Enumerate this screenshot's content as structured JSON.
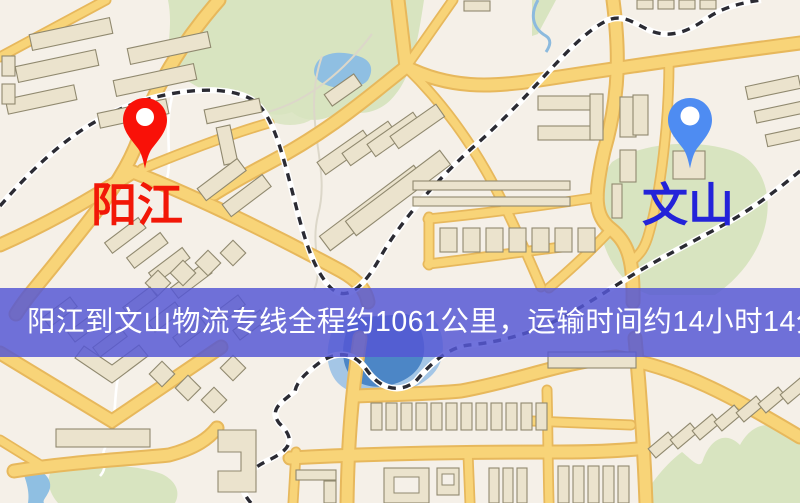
{
  "banner": {
    "text": "阳江到文山物流专线全程约1061公里，运输时间约14小时14分钟.",
    "background_color": "#5557d4",
    "text_color": "#ffffff"
  },
  "markers": [
    {
      "name": "origin",
      "label": "阳江",
      "pin_color": "#f91108",
      "label_color": "#f21707"
    },
    {
      "name": "destination",
      "label": "文山",
      "pin_color": "#4e8cf2",
      "label_color": "#2323d9"
    }
  ],
  "route": {
    "origin": "阳江",
    "destination": "文山",
    "distance": "约1061公里",
    "duration": "约14小时14分钟"
  },
  "map_palette": {
    "map_bg": "#f5f0e8",
    "green": "#d8e4c0",
    "water_light": "#a4c6e6",
    "water": "#8fbfe2",
    "water_deep": "#4c86c6",
    "road": "#f8d478",
    "road_casing": "#e7b85c",
    "building": "#ebe3cd",
    "building_stroke": "#90896f",
    "rail_dark": "#2b2b33"
  }
}
